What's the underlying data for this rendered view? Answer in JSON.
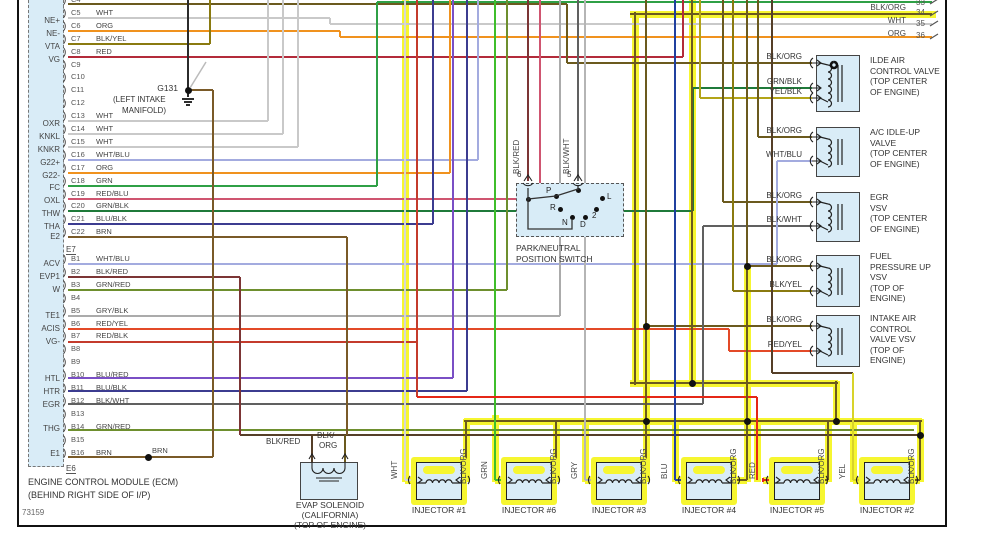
{
  "ref_number": "73159",
  "ecm": {
    "title_lines": [
      "ENGINE CONTROL MODULE (ECM)",
      "(BEHIND RIGHT SIDE OF I/P)"
    ],
    "connector_mid": "E7",
    "connector_end": "E6",
    "left_labels": [
      "NE+",
      "NE-",
      "VTA",
      "VG",
      "OXR",
      "KNKL",
      "KNKR",
      "G22+",
      "G22-",
      "FC",
      "OXL",
      "THW",
      "THA",
      "E2",
      "ACV",
      "EVP1",
      "W",
      "TE1",
      "ACIS",
      "VG-",
      "HTL",
      "HTR",
      "EGR",
      "THG",
      "E1"
    ],
    "pins_c": [
      {
        "id": "C4",
        "color": ""
      },
      {
        "id": "C5",
        "color": "WHT"
      },
      {
        "id": "C6",
        "color": "ORG"
      },
      {
        "id": "C7",
        "color": "BLK/YEL"
      },
      {
        "id": "C8",
        "color": "RED"
      },
      {
        "id": "C9",
        "color": ""
      },
      {
        "id": "C10",
        "color": ""
      },
      {
        "id": "C11",
        "color": ""
      },
      {
        "id": "C12",
        "color": ""
      },
      {
        "id": "C13",
        "color": "WHT"
      },
      {
        "id": "C14",
        "color": "WHT"
      },
      {
        "id": "C15",
        "color": "WHT"
      },
      {
        "id": "C16",
        "color": "WHT/BLU"
      },
      {
        "id": "C17",
        "color": "ORG"
      },
      {
        "id": "C18",
        "color": "GRN"
      },
      {
        "id": "C19",
        "color": "RED/BLU"
      },
      {
        "id": "C20",
        "color": "GRN/BLK"
      },
      {
        "id": "C21",
        "color": "BLU/BLK"
      },
      {
        "id": "C22",
        "color": "BRN"
      }
    ],
    "pins_b": [
      {
        "id": "B1",
        "color": "WHT/BLU"
      },
      {
        "id": "B2",
        "color": "BLK/RED"
      },
      {
        "id": "B3",
        "color": "GRN/RED"
      },
      {
        "id": "B4",
        "color": ""
      },
      {
        "id": "B5",
        "color": "GRY/BLK"
      },
      {
        "id": "B6",
        "color": "RED/YEL"
      },
      {
        "id": "B7",
        "color": "RED/BLK"
      },
      {
        "id": "B8",
        "color": ""
      },
      {
        "id": "B9",
        "color": ""
      },
      {
        "id": "B10",
        "color": "BLU/RED"
      },
      {
        "id": "B11",
        "color": "BLU/BLK"
      },
      {
        "id": "B12",
        "color": "BLK/WHT"
      },
      {
        "id": "B13",
        "color": ""
      },
      {
        "id": "B14",
        "color": "GRN/RED"
      },
      {
        "id": "B15",
        "color": ""
      },
      {
        "id": "B16",
        "color": "BRN"
      }
    ],
    "b16_splice_label": "BRN"
  },
  "ground": {
    "name": "G131",
    "lines": [
      "(LEFT INTAKE",
      "MANIFOLD)"
    ]
  },
  "park_switch": {
    "pin_numbers": [
      "6",
      "5"
    ],
    "wire_labels": [
      "BLK/RED",
      "BLK/WHT"
    ],
    "contacts": [
      "P",
      "R",
      "N",
      "D",
      "2",
      "L"
    ],
    "label_lines": [
      "PARK/NEUTRAL",
      "POSITION SWITCH"
    ]
  },
  "valves": [
    {
      "lines": [
        "ILDE AIR",
        "CONTROL VALVE",
        "(TOP CENTER",
        "OF ENGINE)"
      ],
      "pins": [
        "BLK/ORG",
        "GRN/BLK",
        "YEL/BLK"
      ]
    },
    {
      "lines": [
        "A/C IDLE-UP",
        "VALVE",
        "(TOP CENTER",
        "OF ENGINE)"
      ],
      "pins": [
        "BLK/ORG",
        "WHT/BLU"
      ]
    },
    {
      "lines": [
        "EGR",
        "VSV",
        "(TOP CENTER",
        "OF ENGINE)"
      ],
      "pins": [
        "BLK/ORG",
        "BLK/WHT"
      ]
    },
    {
      "lines": [
        "FUEL",
        "PRESSURE UP",
        "VSV",
        "(TOP OF",
        "ENGINE)"
      ],
      "pins": [
        "BLK/ORG",
        "BLK/YEL"
      ]
    },
    {
      "lines": [
        "INTAKE AIR",
        "CONTROL",
        "VALVE VSV",
        "(TOP OF",
        "ENGINE)"
      ],
      "pins": [
        "BLK/ORG",
        "RED/YEL"
      ]
    }
  ],
  "evap": {
    "pin_label_left": "BLK/RED",
    "pin_label_right_lines": [
      "BLK/",
      "ORG"
    ],
    "label_lines": [
      "EVAP SOLENOID",
      "(CALIFORNIA)",
      "(TOP OF ENGINE)"
    ]
  },
  "injectors": [
    {
      "name": "INJECTOR #1",
      "feed": "WHT",
      "return": "BLK/ORG"
    },
    {
      "name": "INJECTOR #6",
      "feed": "GRN",
      "return": "BLK/ORG"
    },
    {
      "name": "INJECTOR #3",
      "feed": "GRY",
      "return": "BLK/ORG"
    },
    {
      "name": "INJECTOR #4",
      "feed": "BLU",
      "return": "BLK/ORG"
    },
    {
      "name": "INJECTOR #5",
      "feed": "RED",
      "return": "BLK/ORG"
    },
    {
      "name": "INJECTOR #2",
      "feed": "YEL",
      "return": "BLK/ORG"
    }
  ],
  "circuits": [
    {
      "num": "33",
      "label": ""
    },
    {
      "num": "34",
      "label": "BLK/ORG"
    },
    {
      "num": "35",
      "label": "WHT"
    },
    {
      "num": "36",
      "label": "ORG"
    }
  ],
  "wire_colors": {
    "WHT": "#c9c9c9",
    "ORG": "#f0921e",
    "BLK/YEL": "#8a7a10",
    "RED": "#b32b3a",
    "BLK": "#2b2b2b",
    "BRN": "#7a5a28",
    "WHT/BLU": "#a3abdf",
    "GRN": "#2fa046",
    "RED/BLU": "#cf5570",
    "GRN/BLK": "#1f7a3a",
    "BLU/BLK": "#3c3c90",
    "BLK/RED": "#7c3535",
    "GRN/RED": "#6e8f2e",
    "GRY/BLK": "#ababab",
    "RED/YEL": "#e34a28",
    "RED/BLK": "#c43b2c",
    "BLU/RED": "#7a4fc5",
    "BLK/WHT": "#606060",
    "BLK/ORG": "#6b5a1e",
    "YEL/BLK": "#b3a418",
    "DARK": "#553f28",
    "highlight": "#f6f630"
  },
  "injector_feed_colors": {
    "WHT": "#d6d6d6",
    "GRN": "#3fbe2b",
    "GRY": "#b5b5b5",
    "BLU": "#20409f",
    "RED": "#e52716",
    "YEL": "#d8d32a"
  }
}
